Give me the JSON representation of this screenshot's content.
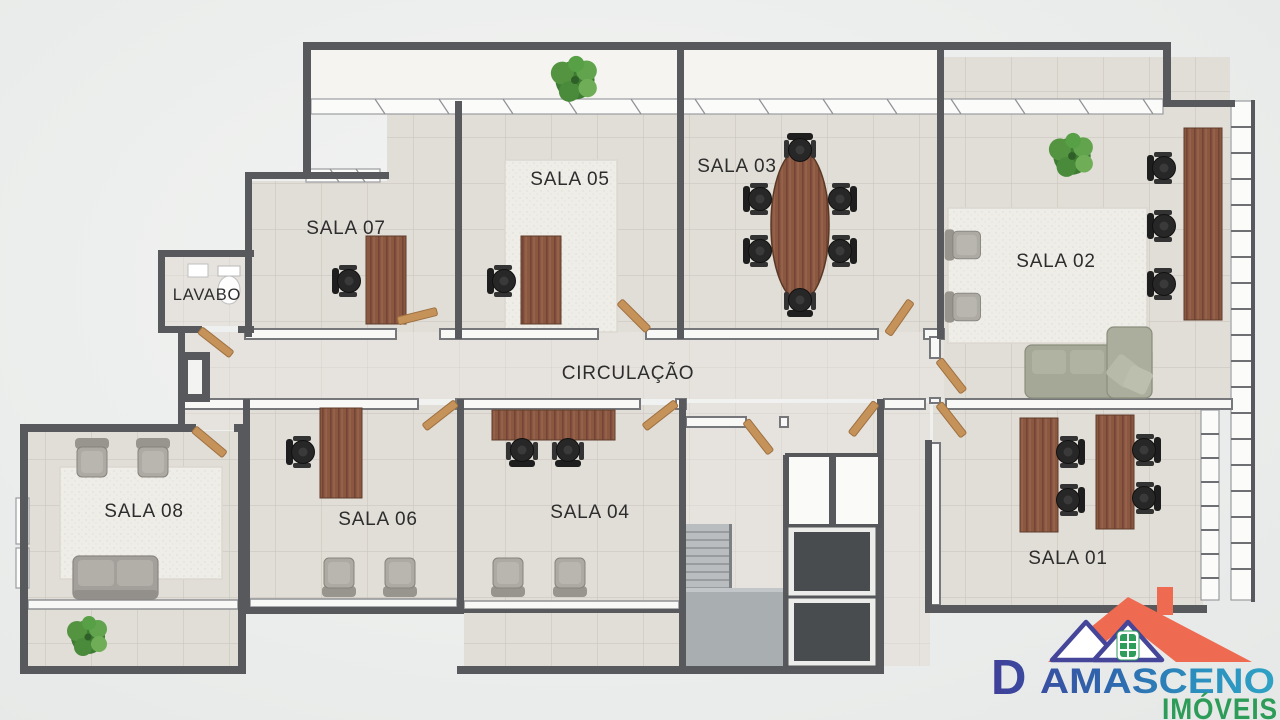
{
  "page": {
    "type": "apartment-office-floor-plan-render"
  },
  "rooms": {
    "sala01": "SALA 01",
    "sala02": "SALA 02",
    "sala03": "SALA 03",
    "sala04": "SALA 04",
    "sala05": "SALA 05",
    "sala06": "SALA 06",
    "sala07": "SALA 07",
    "sala08": "SALA 08",
    "lavabo": "LAVABO",
    "circulacao": "CIRCULAÇÃO"
  },
  "logo": {
    "brand_initial": "D",
    "brand_rest": "AMASCENO",
    "brand_full": "DAMASCENO",
    "tagline": "IMÓVEIS",
    "icon": "house-roof-icon",
    "colors": {
      "brand_navy": "#403f99",
      "brand_blue": "#2d6fb0",
      "brand_teal": "#2fa3c5",
      "tagline_green": "#2e9c59",
      "roof_coral": "#ee6a50",
      "house_outline_navy": "#45459a",
      "window_green": "#2e9d5a"
    }
  },
  "palette": {
    "wall_gray": "#57595c",
    "floor_tile": "#e1ddd7",
    "rug_white": "#efede8",
    "wood_brown": "#8a5741",
    "door_tan": "#c5935a",
    "chair_black": "#262626",
    "sofa_gray": "#a5a896",
    "stairs_concrete": "#a9aeb0",
    "plant_green": "#4e8f3a"
  }
}
